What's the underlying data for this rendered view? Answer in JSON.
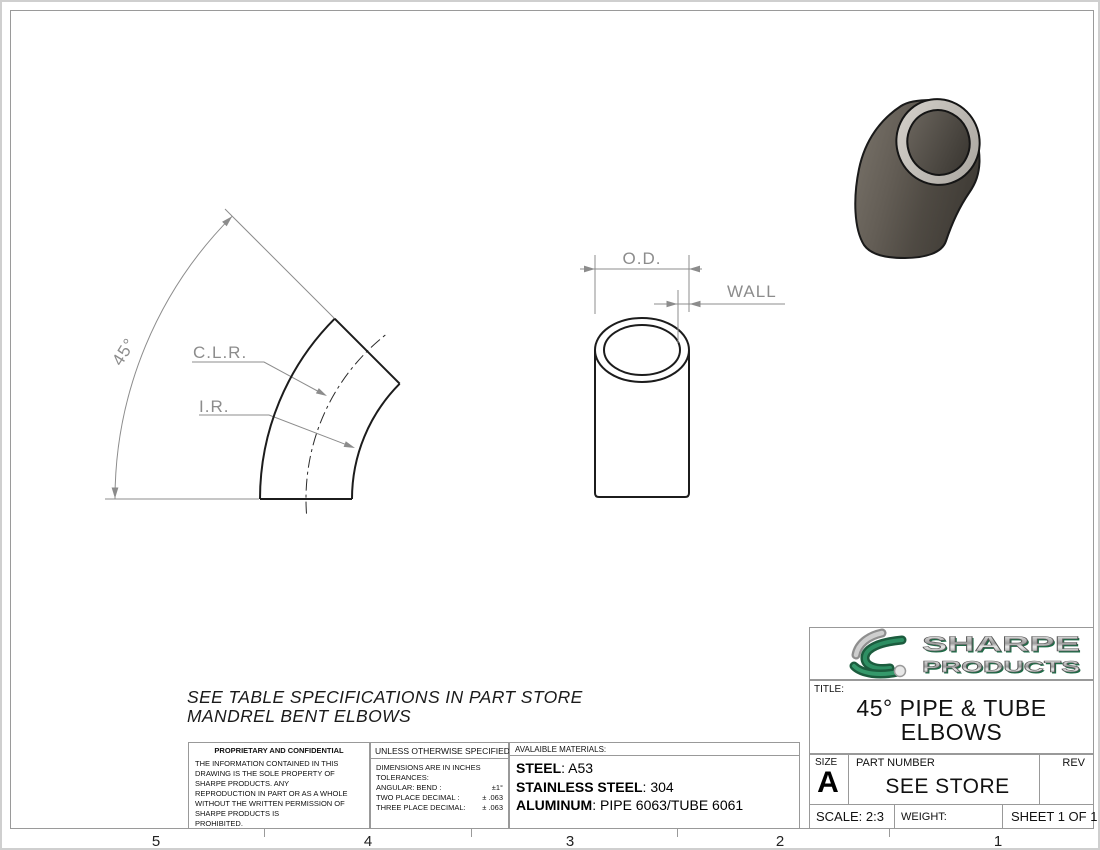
{
  "drawing": {
    "note_line1": "SEE TABLE SPECIFICATIONS IN PART STORE",
    "note_line2": "MANDREL BENT ELBOWS",
    "elbow_view": {
      "angle_label": "45°",
      "clr_label": "C.L.R.",
      "ir_label": "I.R."
    },
    "section_view": {
      "od_label": "O.D.",
      "wall_label": "WALL"
    }
  },
  "proprietary": {
    "header": "PROPRIETARY AND CONFIDENTIAL",
    "body_lines": [
      "THE INFORMATION CONTAINED IN THIS",
      "DRAWING IS THE SOLE PROPERTY OF",
      "SHARPE PRODUCTS.  ANY",
      "REPRODUCTION IN PART OR AS A WHOLE",
      "WITHOUT THE WRITTEN PERMISSION OF",
      "SHARPE PRODUCTS IS",
      "PROHIBITED."
    ]
  },
  "tolerances": {
    "header": "UNLESS OTHERWISE SPECIFIED:",
    "line1": "DIMENSIONS ARE IN INCHES",
    "line2": "TOLERANCES:",
    "angular_label": "ANGULAR: BEND :",
    "angular_value": "±1°",
    "two_place_label": "TWO PLACE DECIMAL  :",
    "two_place_value": "± .063",
    "three_place_label": "THREE PLACE DECIMAL:",
    "three_place_value": "± .063"
  },
  "materials": {
    "header": "AVALAIBLE MATERIALS:",
    "items": [
      {
        "label": "STEEL",
        "value": ": A53"
      },
      {
        "label": "STAINLESS STEEL",
        "value": ": 304"
      },
      {
        "label": "ALUMINUM",
        "value": ": PIPE 6063/TUBE 6061"
      }
    ]
  },
  "title_block": {
    "brand_line1": "SHARPE",
    "brand_line2": "PRODUCTS",
    "title_label": "TITLE:",
    "title_line1": "45° PIPE & TUBE",
    "title_line2": "ELBOWS",
    "size_label": "SIZE",
    "size_value": "A",
    "part_number_label": "PART NUMBER",
    "part_number_value": "SEE STORE",
    "rev_label": "REV",
    "scale": "SCALE: 2:3",
    "weight_label": "WEIGHT:",
    "sheet": "SHEET 1 OF 1"
  },
  "zones": [
    "5",
    "4",
    "3",
    "2",
    "1"
  ],
  "colors": {
    "part_line": "#1c1c1c",
    "dimension_gray": "#8c8c8c",
    "brand_green": "#2a7a52",
    "elbow_body_dark": "#46423b",
    "elbow_ring_silver": "#bfbbb5"
  }
}
